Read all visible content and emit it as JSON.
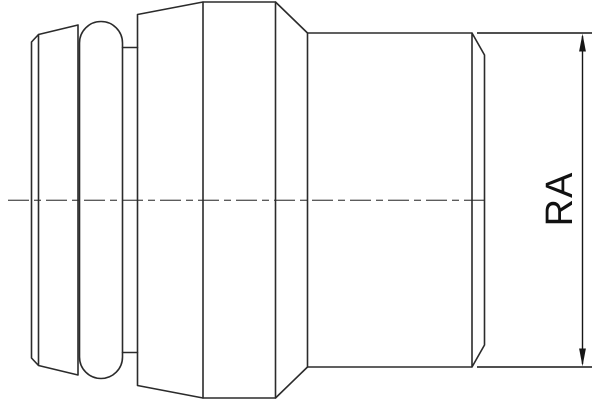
{
  "drawing": {
    "dimension_label": "RA",
    "colors": {
      "background": "#ffffff",
      "outline": "#2b2b2b",
      "centerline": "#5c5c5c",
      "dimension": "#161616",
      "label": "#111111"
    }
  }
}
